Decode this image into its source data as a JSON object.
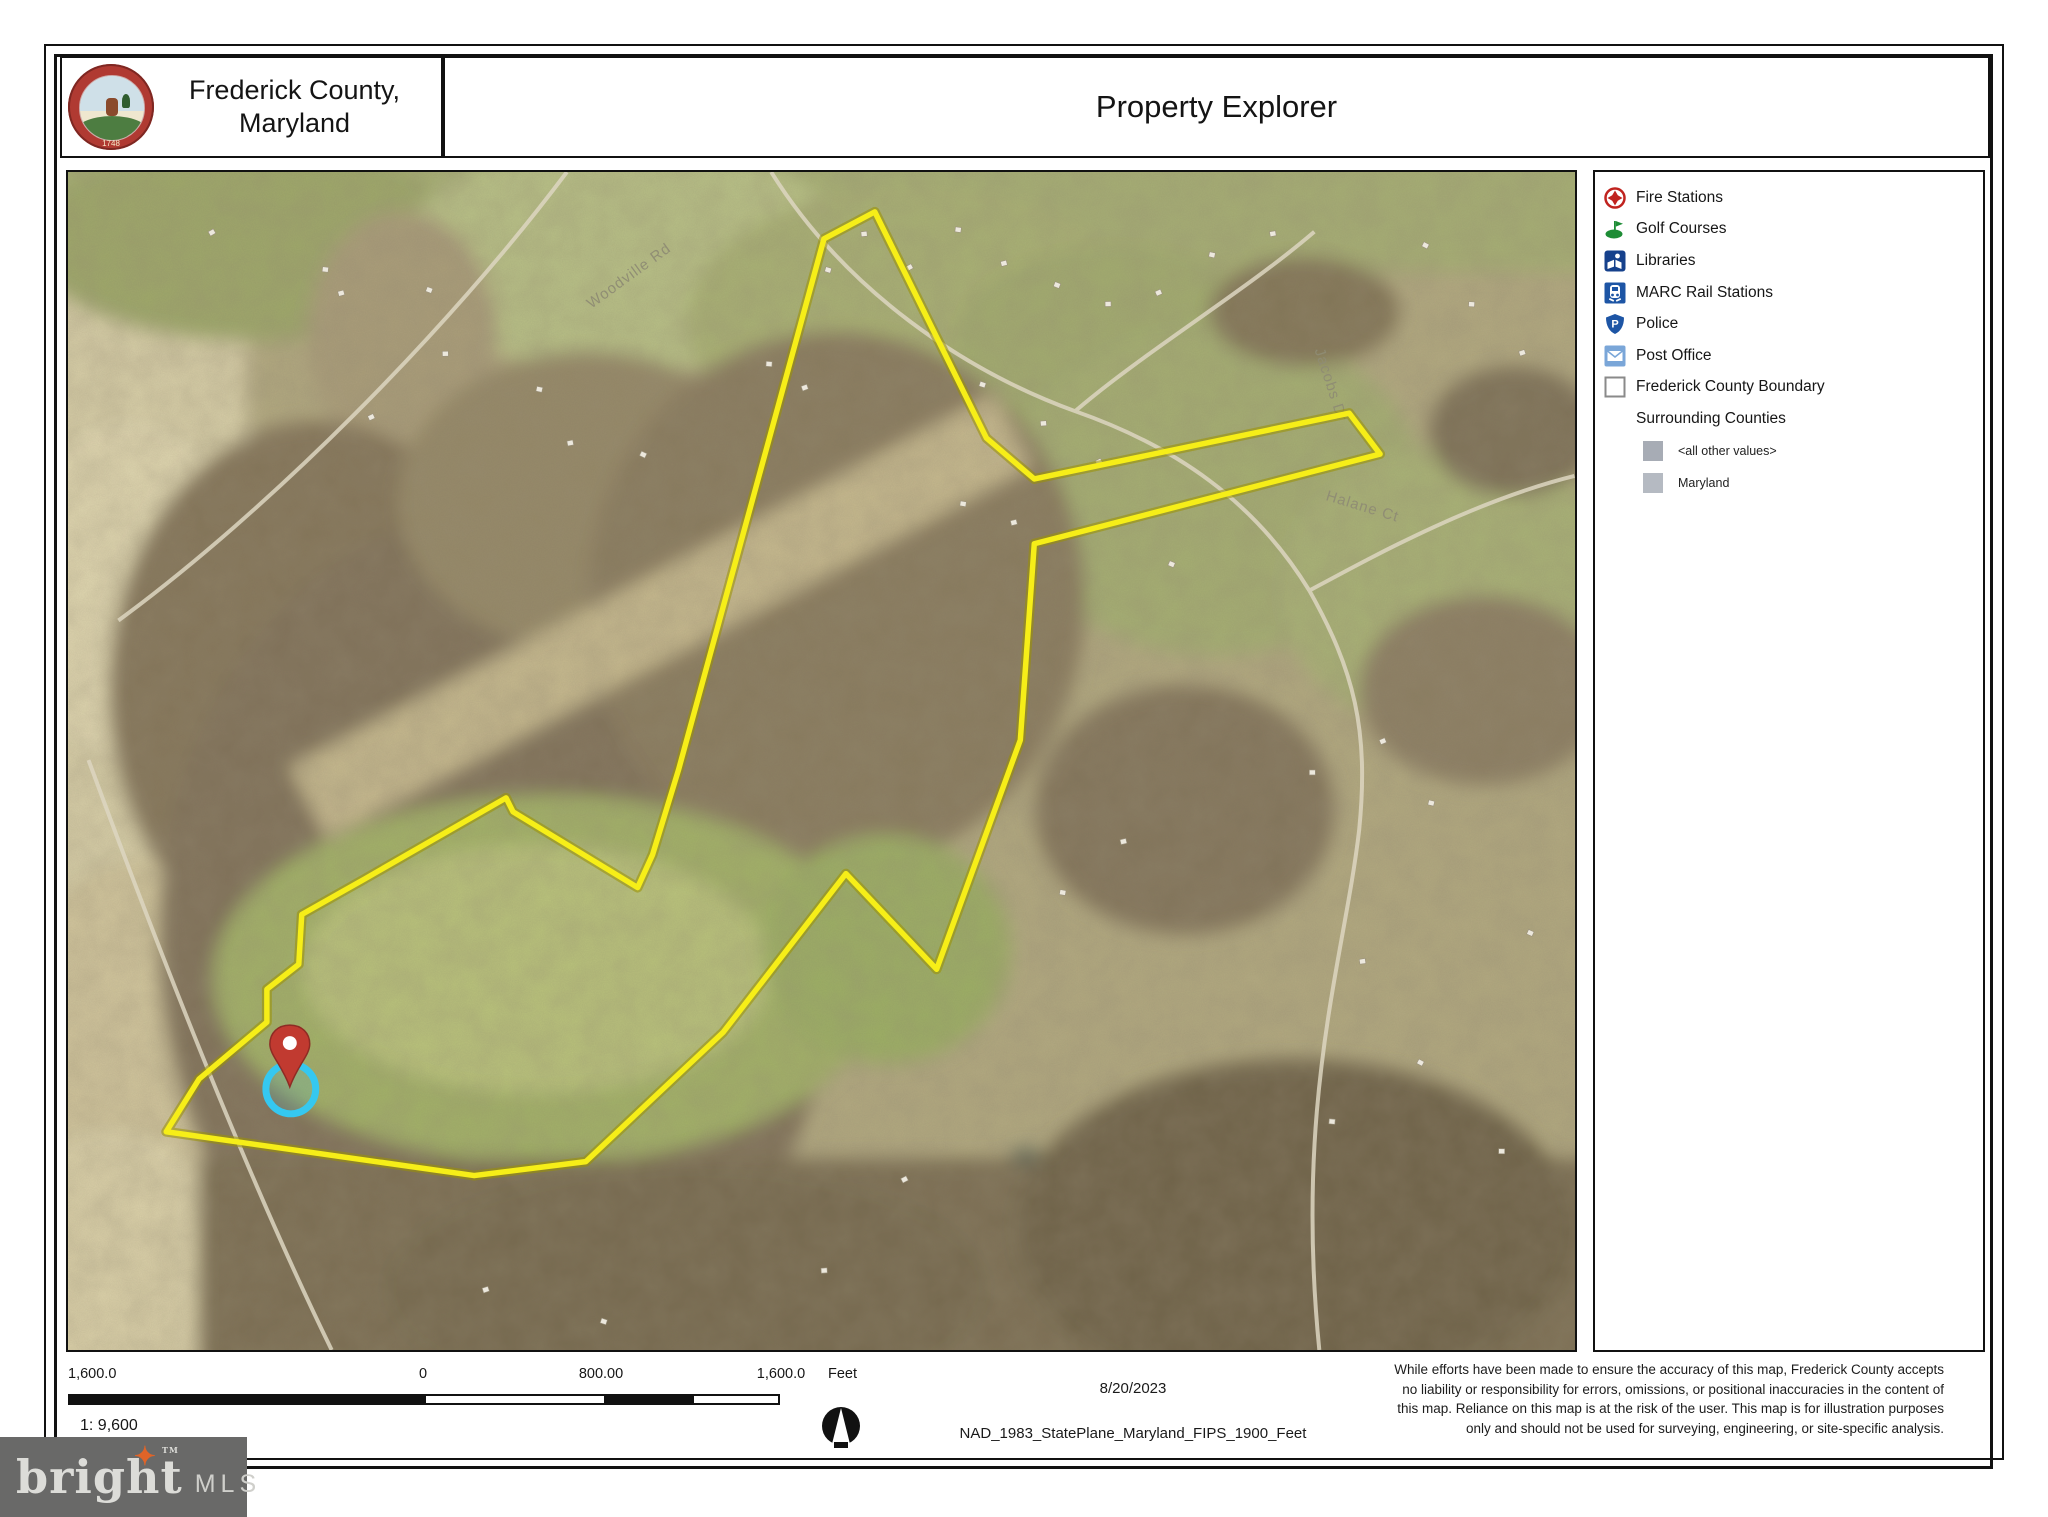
{
  "header": {
    "county_name_line1": "Frederick County,",
    "county_name_line2": "Maryland",
    "seal_year": "1748",
    "title": "Property Explorer"
  },
  "legend": {
    "items": [
      {
        "label": "Fire Stations",
        "icon": "fire-stations-icon",
        "color": "#c0231f"
      },
      {
        "label": "Golf Courses",
        "icon": "golf-courses-icon",
        "color": "#1d8c35"
      },
      {
        "label": "Libraries",
        "icon": "libraries-icon",
        "color": "#16418c"
      },
      {
        "label": "MARC Rail Stations",
        "icon": "marc-rail-icon",
        "color": "#1d55a5"
      },
      {
        "label": "Police",
        "icon": "police-icon",
        "color": "#1d55a5"
      },
      {
        "label": "Post Office",
        "icon": "post-office-icon",
        "color": "#7aa6d8"
      },
      {
        "label": "Frederick County Boundary",
        "icon": "county-boundary-icon",
        "color": "#ffffff"
      },
      {
        "label": "Surrounding Counties",
        "icon": "none",
        "color": ""
      }
    ],
    "sub_items": [
      {
        "label": "<all other values>",
        "color": "#a7acb5"
      },
      {
        "label": "Maryland",
        "color": "#b5bac2"
      }
    ]
  },
  "map": {
    "boundary_points": [
      [
        809,
        40
      ],
      [
        921,
        267
      ],
      [
        969,
        308
      ],
      [
        1285,
        242
      ],
      [
        1316,
        283
      ],
      [
        969,
        373
      ],
      [
        955,
        570
      ],
      [
        871,
        800
      ],
      [
        780,
        704
      ],
      [
        657,
        863
      ],
      [
        519,
        993
      ],
      [
        407,
        1007
      ],
      [
        98,
        963
      ],
      [
        131,
        910
      ],
      [
        199,
        853
      ],
      [
        199,
        820
      ],
      [
        231,
        795
      ],
      [
        234,
        745
      ],
      [
        296,
        710
      ],
      [
        439,
        628
      ],
      [
        446,
        642
      ],
      [
        571,
        718
      ],
      [
        586,
        685
      ],
      [
        612,
        600
      ],
      [
        758,
        67
      ]
    ],
    "pin": {
      "x": 222,
      "y": 878,
      "halo_dx": 1,
      "halo_dy": 42,
      "halo_r": 25
    },
    "road_labels": [
      {
        "text": "Woodville Rd",
        "x": 565,
        "y": 108,
        "angle": -36
      },
      {
        "text": "Jacobs Dr",
        "x": 1262,
        "y": 215,
        "angle": 72
      },
      {
        "text": "Halane Ct",
        "x": 1297,
        "y": 340,
        "angle": 17
      }
    ],
    "colors": {
      "boundary": "#f6ee18",
      "boundary_glow": "#9b9100",
      "pin_red": "#c13a30",
      "pin_red_dark": "#8e2b24",
      "halo_cyan": "#35c8f0"
    }
  },
  "footer": {
    "scale_labels": [
      "1,600.0",
      "0",
      "800.00",
      "1,600.0"
    ],
    "unit": "Feet",
    "ratio": "1: 9,600",
    "date": "8/20/2023",
    "projection": "NAD_1983_StatePlane_Maryland_FIPS_1900_Feet",
    "disclaimer": "While efforts have been made to ensure the accuracy of this map, Frederick County accepts no liability or responsibility for errors, omissions, or positional inaccuracies in the content of this map. Reliance on this map is at the risk of the user. This map is for illustration purposes only and should not be used for surveying, engineering, or site-specific analysis."
  },
  "logo": {
    "brand": "bright",
    "suffix": "MLS",
    "tm": "TM",
    "star": "✦",
    "colors": {
      "bg": "#696968",
      "text": "#dcdcd8",
      "suffix_text": "#cfcfcb",
      "star": "#e06428"
    }
  }
}
